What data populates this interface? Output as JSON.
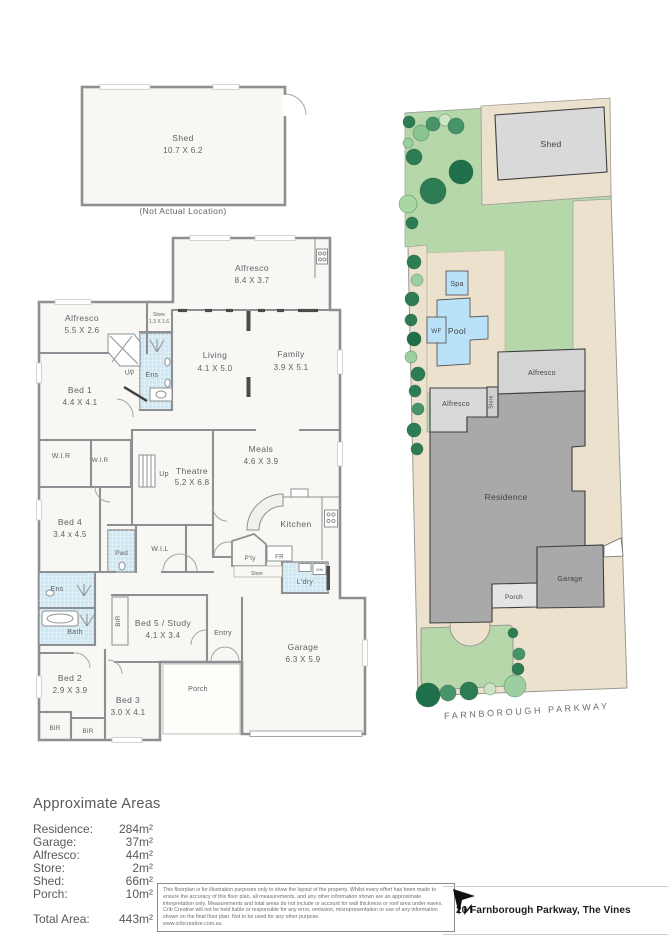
{
  "shed_inset": {
    "label": "Shed",
    "dims": "10.7 X 6.2",
    "note": "(Not Actual Location)"
  },
  "floorplan": {
    "alfresco_top": {
      "label": "Alfresco",
      "dims": "8.4 X 3.7"
    },
    "alfresco_left": {
      "label": "Alfresco",
      "dims": "5.5 X 2.6"
    },
    "store_top": {
      "label": "Store",
      "dims": "1.3 X 1.6"
    },
    "bed1": {
      "label": "Bed 1",
      "dims": "4.4 X 4.1"
    },
    "living": {
      "label": "Living",
      "dims": "4.1 X 5.0"
    },
    "family": {
      "label": "Family",
      "dims": "3.9 X 5.1"
    },
    "meals": {
      "label": "Meals",
      "dims": "4.6 X 3.9"
    },
    "theatre": {
      "label": "Theatre",
      "dims": "5.2 X 6.8"
    },
    "bed4": {
      "label": "Bed 4",
      "dims": "3.4 x 4.5"
    },
    "bed5": {
      "label": "Bed 5 / Study",
      "dims": "4.1 X 3.4"
    },
    "bed2": {
      "label": "Bed 2",
      "dims": "2.9 X 3.9"
    },
    "bed3": {
      "label": "Bed 3",
      "dims": "3.0 X 4.1"
    },
    "garage": {
      "label": "Garage",
      "dims": "6.3 X 5.9"
    },
    "small": {
      "up1": "Up",
      "ens1": "Ens",
      "wir1": "W.I.R",
      "wir2": "W.I.R",
      "up2": "Up",
      "pwd": "Pwd",
      "wil": "W.I.L",
      "kitchen": "Kitchen",
      "pantry": "P'ty",
      "fridge": "FR",
      "store2": "Store",
      "laundry": "L'dry",
      "wm": "WM",
      "ens2": "Ens",
      "bath": "Bath",
      "bir1": "BIR",
      "bir2": "BIR",
      "bir3": "BIR",
      "entry": "Entry",
      "porch": "Porch"
    }
  },
  "siteplan": {
    "shed": "Shed",
    "spa": "Spa",
    "wf": "WF",
    "pool": "Pool",
    "alfresco_main": "Alfresco",
    "alfresco_small": "Alfresco",
    "store": "Store",
    "residence": "Residence",
    "garage": "Garage",
    "porch": "Porch",
    "street": "FARNBOROUGH PARKWAY"
  },
  "areas": {
    "title": "Approximate Areas",
    "rows": [
      {
        "label": "Residence:",
        "value": "284m²"
      },
      {
        "label": "Garage:",
        "value": "37m²"
      },
      {
        "label": "Alfresco:",
        "value": "44m²"
      },
      {
        "label": "Store:",
        "value": "2m²"
      },
      {
        "label": "Shed:",
        "value": "66m²"
      },
      {
        "label": "Porch:",
        "value": "10m²"
      }
    ],
    "total_label": "Total Area:",
    "total_value": "443m²"
  },
  "disclaimer": {
    "text": "This floorplan is for illustration purposes only to show the layout of the property. Whilst every effort has been made to ensure the accuracy of this floor plan, all measurements, and any other information shown are an approximate interpretation only. Measurements and total areas do not include or account for wall thickness or roof area under eaves. Crib Creative will not be held liable or responsible for any error, omission, misrepresentation or use of any information shown on the final floor plan. Not to be used for any other purpose.",
    "url": "www.cribcreative.com.au"
  },
  "footer": {
    "address": "20 Farnborough Parkway, The Vines"
  },
  "colors": {
    "lot_beige": "#ece1cd",
    "lawn_green": "#b5d7aa",
    "pool_blue": "#b9e2f8",
    "residence_gray": "#a9a9a9",
    "alfresco_gray": "#d4d4d4",
    "shed_gray": "#d9d9d9",
    "wall_gray": "#8d9092",
    "tile_blue": "#cfe7f2",
    "text_gray": "#5d6166"
  }
}
